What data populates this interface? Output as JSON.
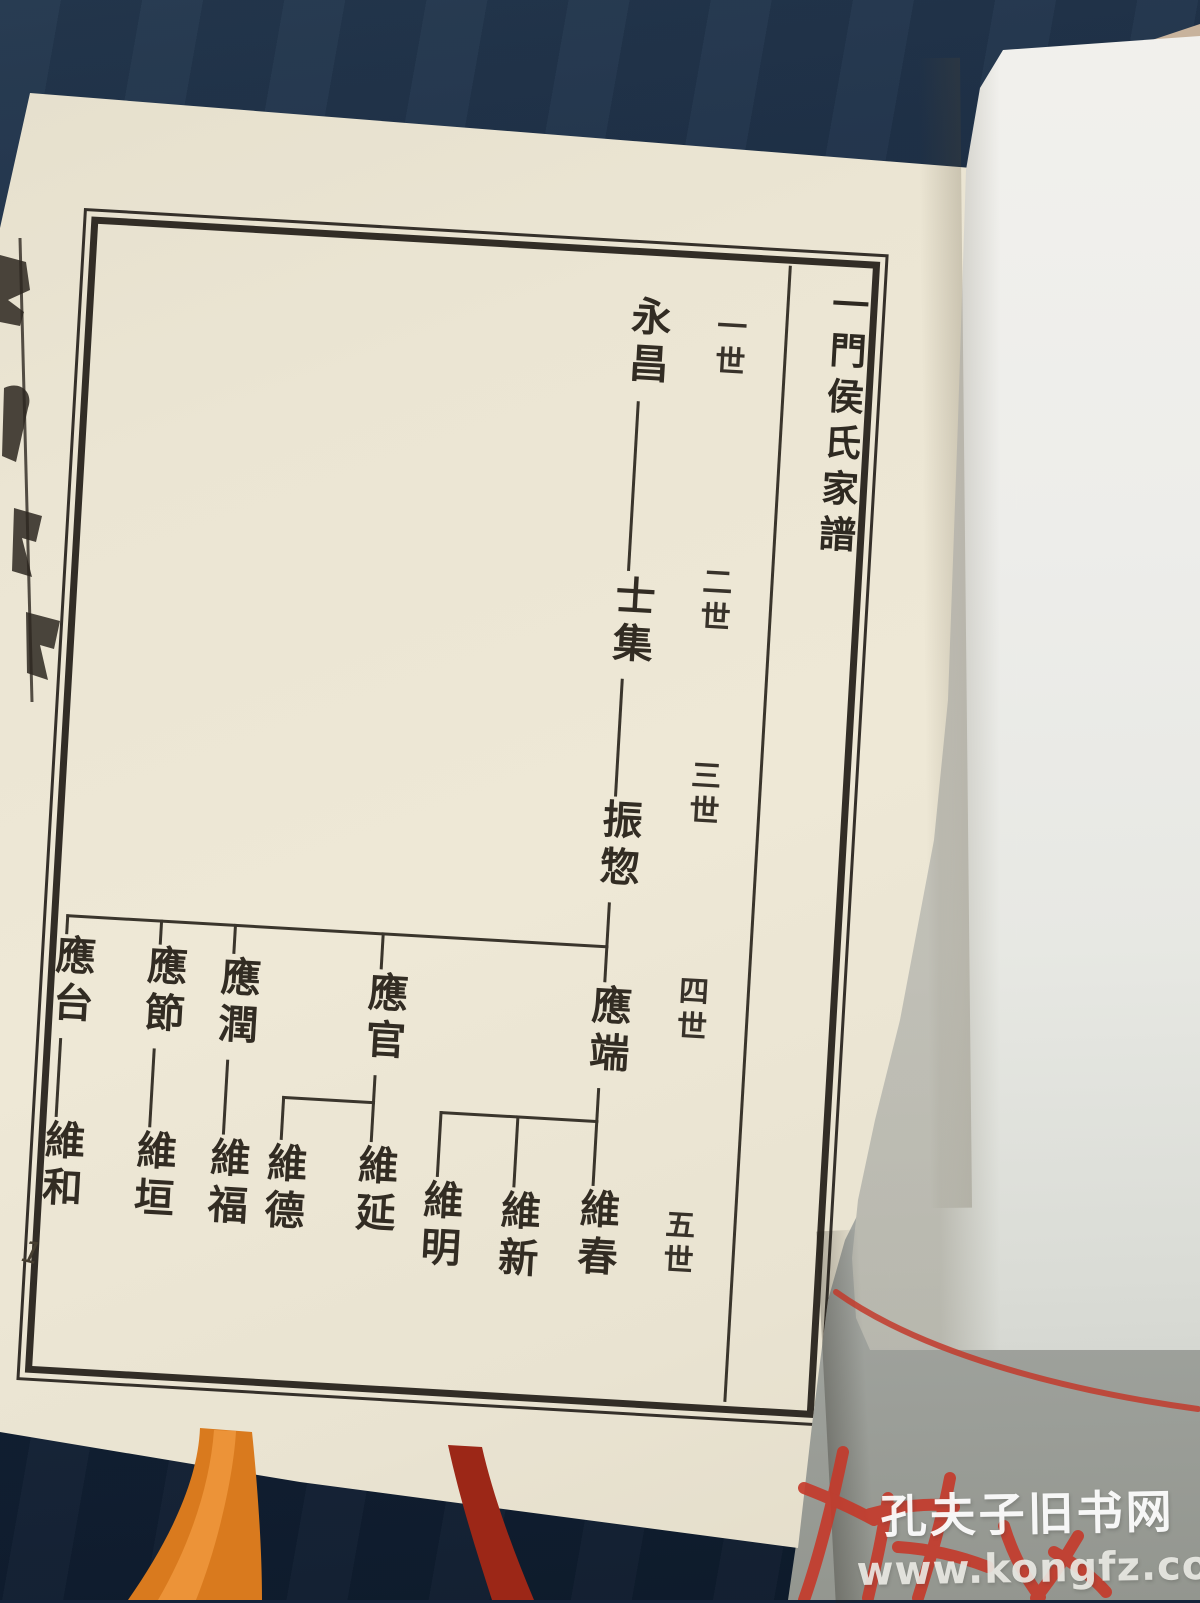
{
  "book": {
    "title": "一門侯氏家譜",
    "page_number": "1",
    "generation_labels": [
      "一世",
      "二世",
      "三世",
      "四世",
      "五世"
    ],
    "tree": {
      "gen1": [
        "永昌"
      ],
      "gen2": [
        "士集"
      ],
      "gen3": [
        "振惣"
      ],
      "gen4": [
        "應端",
        "應官",
        "應潤",
        "應節",
        "應台"
      ],
      "gen5": [
        "維春",
        "維新",
        "維明",
        "維延",
        "維德",
        "維福",
        "維垣",
        "維和"
      ],
      "relations": [
        {
          "parent": "永昌",
          "children": [
            "士集"
          ]
        },
        {
          "parent": "士集",
          "children": [
            "振惣"
          ]
        },
        {
          "parent": "振惣",
          "children": [
            "應端",
            "應官",
            "應潤",
            "應節",
            "應台"
          ]
        },
        {
          "parent": "應端",
          "children": [
            "維春",
            "維新",
            "維明"
          ]
        },
        {
          "parent": "應官",
          "children": [
            "維延",
            "維德"
          ]
        },
        {
          "parent": "應潤",
          "children": [
            "維福"
          ]
        },
        {
          "parent": "應節",
          "children": [
            "維垣"
          ]
        },
        {
          "parent": "應台",
          "children": [
            "維和"
          ]
        }
      ]
    }
  },
  "watermark": {
    "site_name": "孔夫子旧书网",
    "site_url": "www.kongfz.com"
  },
  "colors": {
    "background_cloth": "#16263c",
    "page_cream": "#ebe5d3",
    "page_white": "#ededea",
    "page_grey": "#b2b5b0",
    "ink": "#322d25",
    "red_marks": "#c23a2b",
    "ribbon_orange": "#d97a1e",
    "ribbon_dark_red": "#9c2717"
  }
}
